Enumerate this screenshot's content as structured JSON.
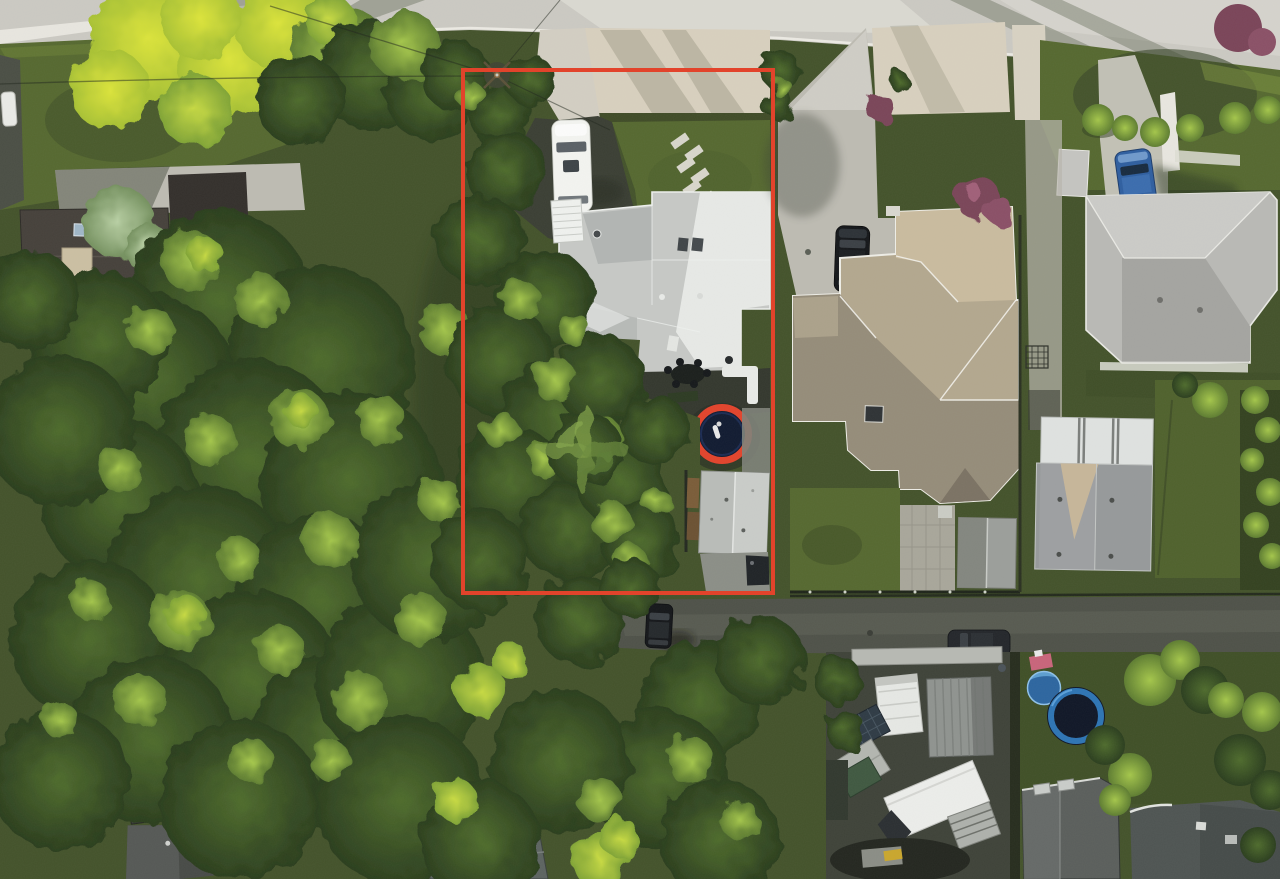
{
  "meta": {
    "title": "Aerial drone photo of residential lot with highlighted property boundary",
    "width": 1280,
    "height": 879
  },
  "annotation": {
    "name": "property-boundary",
    "shape": "rectangle",
    "x": 463,
    "y": 70,
    "width": 310,
    "height": 523,
    "stroke_width": 4,
    "color": "#e2432b"
  },
  "palette": {
    "boundary": "#e2432b",
    "road": "#cbc9c2",
    "road_light": "#dfddd5",
    "sidewalk": "#e8e6df",
    "gravel": "#d8d0be",
    "concrete": "#bdbbb2",
    "asphalt": "#3a3e33",
    "lane": "#4e5148",
    "lawn": "#55682f",
    "lawn_dark": "#43522a",
    "forest": "#2c401e",
    "roof_light": "#c6c8c5",
    "roof_white": "#e9ebe8",
    "roof_tan": "#b3a78e",
    "roof_tan_light": "#c9bb9e",
    "roof_tan_shade": "#958c79",
    "roof_gray": "#b9b9b5",
    "roof_dark": "#45403a",
    "garage_roof": "#b9bcb8",
    "container_gray": "#8f938f",
    "car_white": "#f3f4f0",
    "car_black": "#141619",
    "car_blue": "#2e5e9f",
    "trampoline_blue": "#2d52a0",
    "trampoline_blue2": "#2d74b4",
    "pool_blue": "#2c659f",
    "shrub_purple": "#7a4458"
  },
  "scene": {
    "streets": [
      "paved street along top",
      "rear lane across lower right"
    ],
    "subject_lot": {
      "outlined": true,
      "house_roof_color": "light gray",
      "driveway": "dark asphalt with white car",
      "front_lawn_stepping_stones": 7,
      "backyard": [
        "patio furniture",
        "white sectional sofa",
        "blue trampoline with person",
        "gray-roof garage",
        "raised planter boxes"
      ]
    },
    "right_neighbor": {
      "roof_color": "tan-gray",
      "driveway_vehicle": "black SUV",
      "backyard": [
        "lawn",
        "paver path",
        "gray shed"
      ]
    },
    "far_right": {
      "front": [
        "blue car",
        "bright shrub row",
        "white walkway"
      ],
      "house_roof_color": "gray",
      "workshop": "gray roof with white skylight panels"
    },
    "bottom_right": {
      "storage_yard": [
        "white camper",
        "gray container",
        "white box truck",
        "utility trailer",
        "green container",
        "solar panel"
      ],
      "neighbor_yard": [
        "blue trampoline",
        "blue kiddie pool",
        "play slide"
      ],
      "houses": "dark gray roofs with skylights"
    },
    "vegetation": {
      "dense_tree_canopy": "left half and bottom of frame",
      "sunlit_yellow_tree": "top left",
      "purple_shrubs": 3,
      "bright_hedges": "right edge"
    },
    "vehicles": [
      {
        "name": "white-car",
        "location": "subject driveway"
      },
      {
        "name": "black-suv",
        "location": "neighbor driveway"
      },
      {
        "name": "blue-car",
        "location": "far right driveway"
      },
      {
        "name": "dark-car",
        "location": "rear lane, lower center"
      },
      {
        "name": "dark-car-2",
        "location": "rear lane, right"
      }
    ],
    "utility": "power pole with wires near top of outlined lot"
  }
}
